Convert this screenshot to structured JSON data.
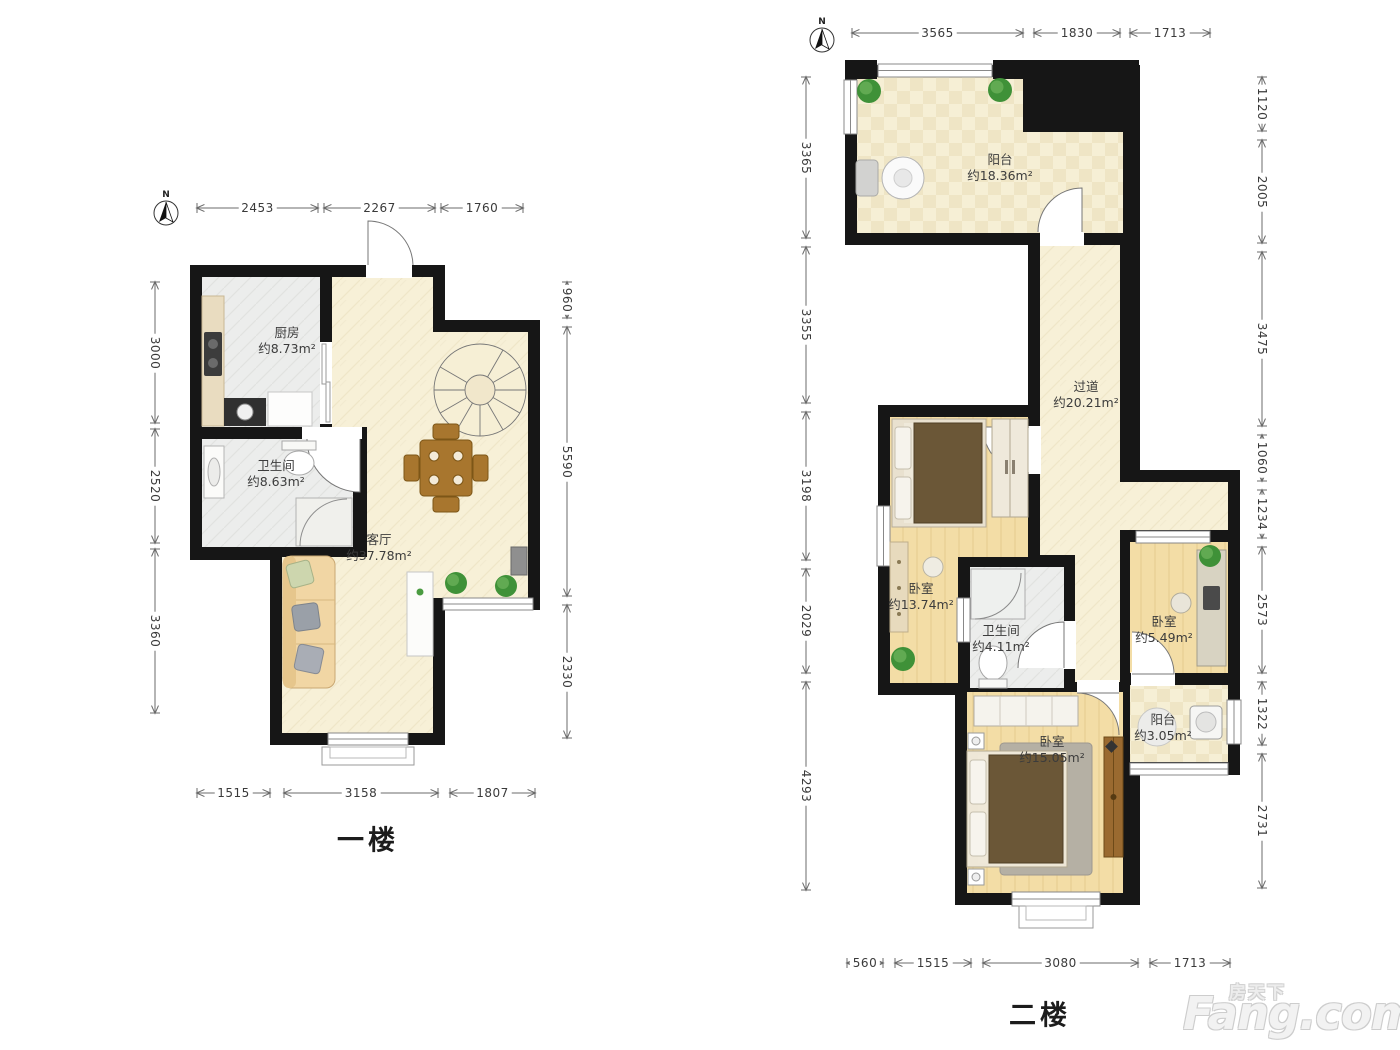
{
  "north": {
    "label": "N"
  },
  "logo": {
    "cn": "房天下",
    "en": "Fang.com"
  },
  "floor1": {
    "label": "一楼",
    "rooms": {
      "kitchen": {
        "name": "厨房",
        "area": "约8.73m²"
      },
      "bath": {
        "name": "卫生间",
        "area": "约8.63m²"
      },
      "living": {
        "name": "客厅",
        "area": "约37.78m²"
      }
    },
    "dims": {
      "top": [
        "2453",
        "2267",
        "1760"
      ],
      "left": [
        "3000",
        "2520",
        "3360"
      ],
      "right": [
        "960",
        "5590",
        "2330"
      ],
      "bottom": [
        "1515",
        "3158",
        "1807"
      ]
    }
  },
  "floor2": {
    "label": "二楼",
    "rooms": {
      "balcony": {
        "name": "阳台",
        "area": "约18.36m²"
      },
      "corridor": {
        "name": "过道",
        "area": "约20.21m²"
      },
      "bedroom1": {
        "name": "卧室",
        "area": "约13.74m²"
      },
      "bath": {
        "name": "卫生间",
        "area": "约4.11m²"
      },
      "bedroom2": {
        "name": "卧室",
        "area": "约5.49m²"
      },
      "balcony2": {
        "name": "阳台",
        "area": "约3.05m²"
      },
      "bedroom3": {
        "name": "卧室",
        "area": "约15.05m²"
      }
    },
    "dims": {
      "top": [
        "3565",
        "1830",
        "1713"
      ],
      "left": [
        "3365",
        "3355",
        "3198",
        "2029",
        "4293"
      ],
      "right": [
        "1120",
        "2005",
        "3475",
        "1060",
        "1234",
        "2573",
        "1322",
        "2731"
      ],
      "bottom": [
        "560",
        "1515",
        "3080",
        "1713"
      ]
    }
  }
}
